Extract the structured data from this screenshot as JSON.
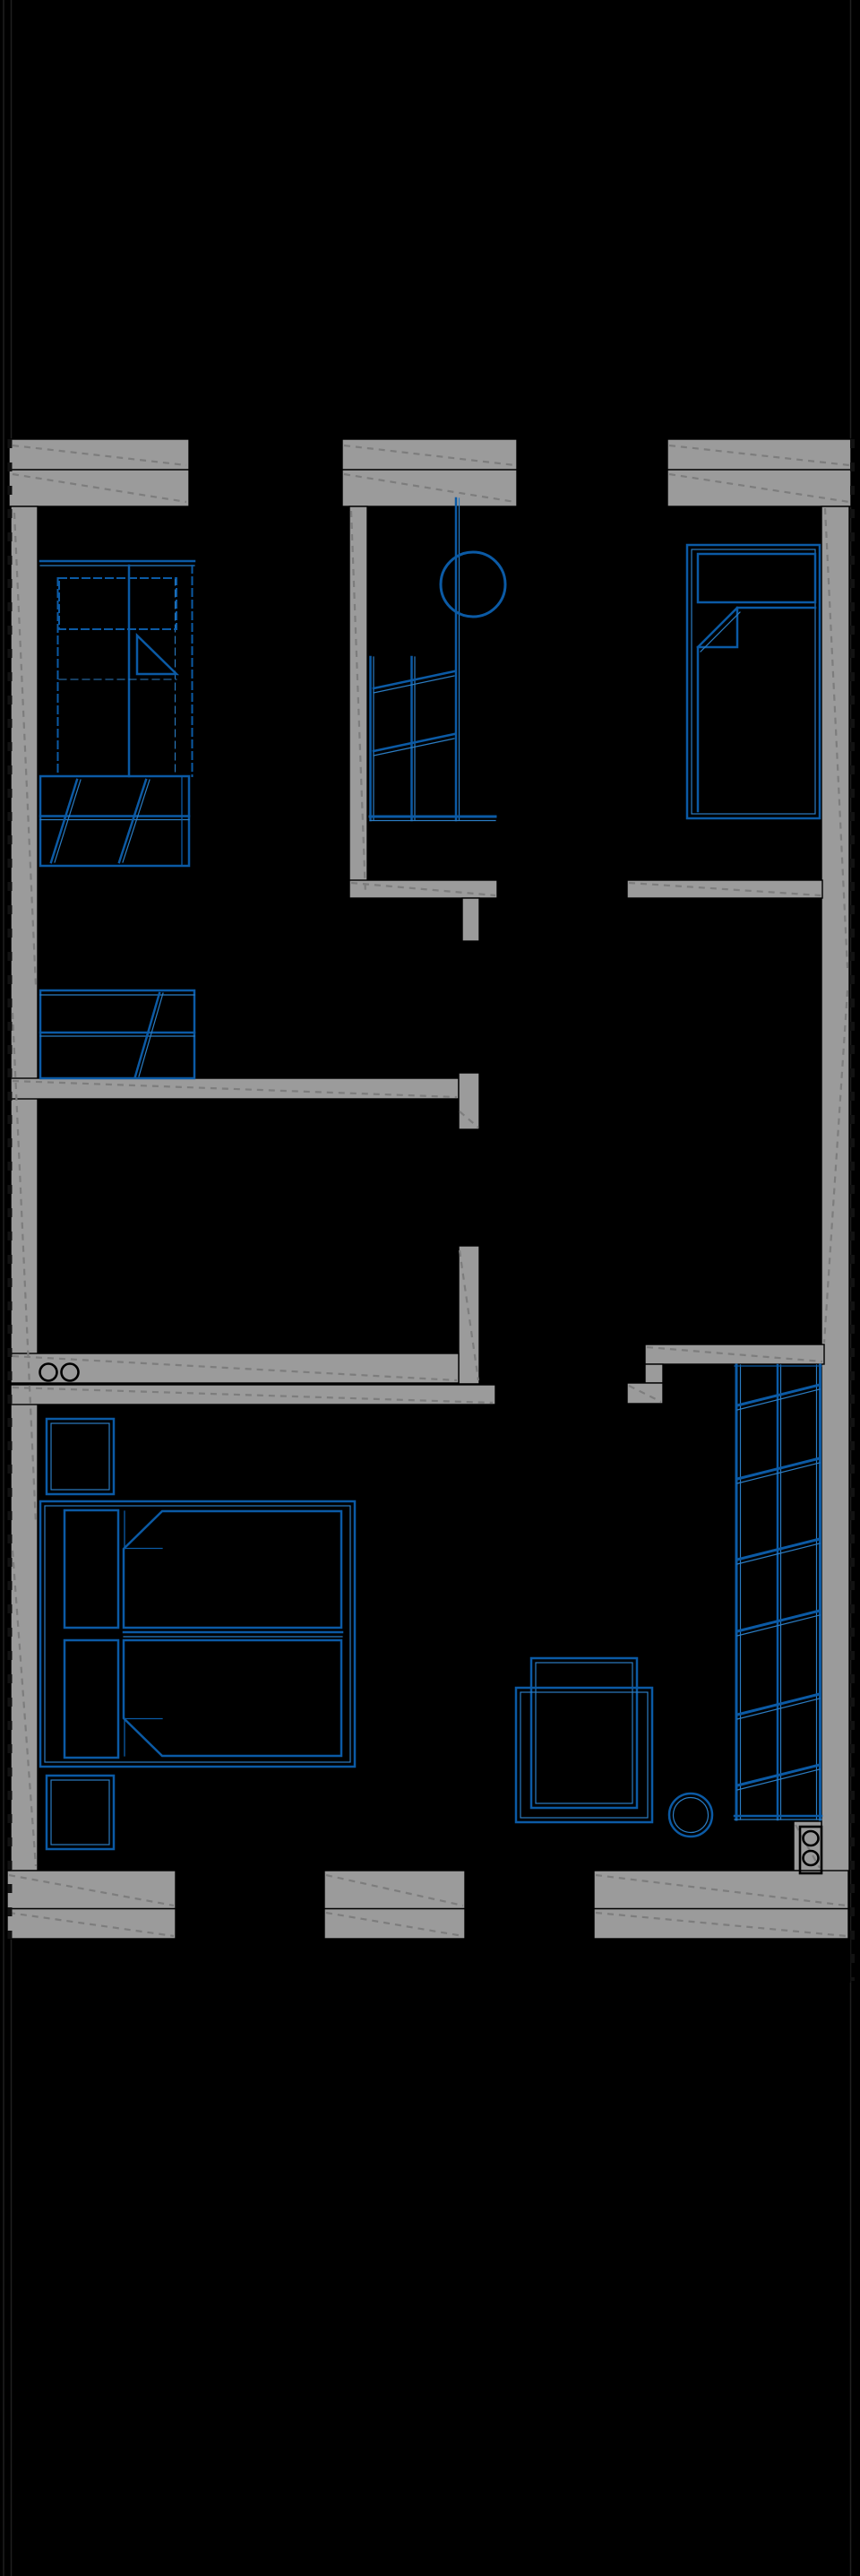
{
  "document": {
    "type": "architectural floor plan",
    "style": "CAD blueprint, white-on-black with gray cut walls and blue furniture symbols",
    "visible_text": "",
    "orientation": "portrait"
  },
  "colors": {
    "background": "#000000",
    "wall_fill": "#9b9b9b",
    "wall_edge": "#000000",
    "wall_hatch": "#7d7d7d",
    "furniture_primary": "#0b5aa5",
    "furniture_secondary": "#2b7cc2",
    "symbol_black": "#000000",
    "frame_line": "#1f1f1f"
  },
  "plan": {
    "exterior": {
      "top_wall_segments": 3,
      "bottom_wall_segments": 3,
      "side_wall_hatch": "dashed diagonal",
      "edge_tick_lines": "dashed black ticks along left and right outer edges"
    },
    "rooms": [
      {
        "id": "bedroom-top-left",
        "furniture": [
          {
            "kind": "single-bed",
            "style": "dashed outline, pillow and folded-corner duvet"
          },
          {
            "kind": "slatted-closet-at-bed-foot",
            "slats": 13,
            "diagonals": 2
          },
          {
            "kind": "slatted-closet-on-corridor",
            "slats": 13,
            "diagonals": 1
          }
        ]
      },
      {
        "id": "stair-hall",
        "furniture": [
          {
            "kind": "staircase",
            "treads": 13,
            "direction_diagonals": 2
          },
          {
            "kind": "handrail",
            "shape": "vertical double line"
          },
          {
            "kind": "newel-circle",
            "count": 1
          },
          {
            "kind": "landing-edge-line",
            "count": 1
          }
        ]
      },
      {
        "id": "bedroom-top-right",
        "furniture": [
          {
            "kind": "single-bed",
            "style": "solid outline, pillow and folded-corner duvet"
          }
        ]
      },
      {
        "id": "bedroom-bottom-left",
        "furniture": [
          {
            "kind": "double-bed",
            "pillows": 2,
            "folded_corners": 2
          },
          {
            "kind": "nightstand",
            "count": 2
          }
        ]
      },
      {
        "id": "bedroom-bottom-right",
        "furniture": [
          {
            "kind": "desk-with-chair",
            "rectangles": 2
          },
          {
            "kind": "round-stool",
            "count": 1
          },
          {
            "kind": "shelved-wardrobe",
            "bays": 2,
            "hanging_rod_diagonals": 6
          },
          {
            "kind": "duct-box-two-circles",
            "circles": 2
          }
        ]
      }
    ],
    "wall_symbols": [
      {
        "kind": "pipe-circles-on-corridor-wall",
        "count": 2
      },
      {
        "kind": "door-jamb-stubs",
        "count": 3
      }
    ]
  }
}
